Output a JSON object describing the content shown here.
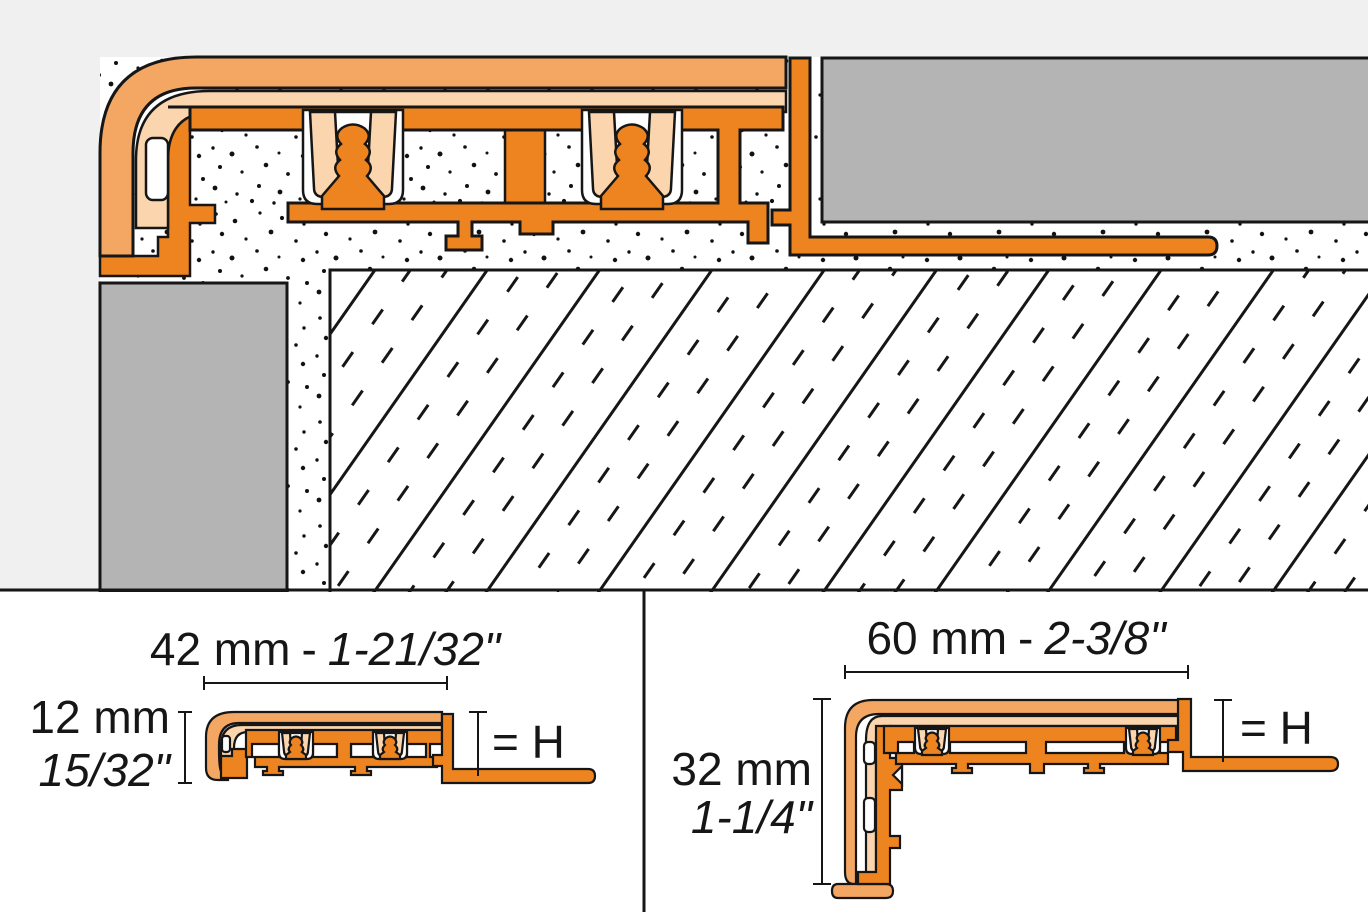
{
  "drawing": {
    "description": "Tile edge / transition profile technical cross-section with installation view and two dimensioned profile views",
    "installation_view": {
      "name": "installation cross-section"
    },
    "left_view": {
      "width_metric": "42 mm",
      "width_sep": "-",
      "width_imperial": "1-21/32\"",
      "height_metric": "12 mm",
      "height_imperial": "15/32\"",
      "height_ref": "= H"
    },
    "right_view": {
      "width_metric": "60 mm",
      "width_sep": "-",
      "width_imperial": "2-3/8\"",
      "height_metric": "32 mm",
      "height_imperial": "1-1/4\"",
      "height_ref": "= H"
    },
    "colors": {
      "profile-orange": "#EE8420",
      "insert-orange": "#F4A763",
      "insert-peach": "#FAD5AE",
      "tile-gray": "#B4B4B4",
      "bg-gray": "#F0F0F0",
      "line": "#161616"
    }
  }
}
